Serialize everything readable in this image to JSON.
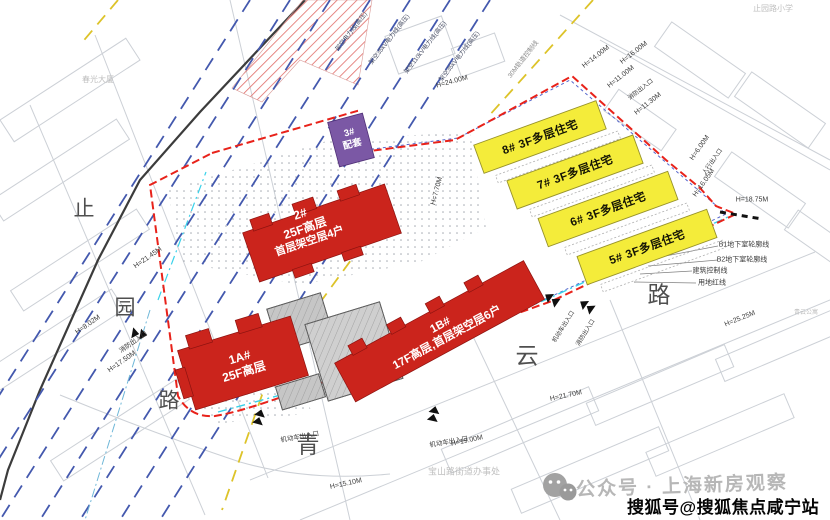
{
  "roads": {
    "left": {
      "name": "止园路",
      "chars": [
        "止",
        "园",
        "路"
      ]
    },
    "bottom": {
      "name": "青云路",
      "chars": [
        "青",
        "云",
        "路"
      ]
    }
  },
  "buildings": {
    "b1a": {
      "line1": "1A#",
      "line2": "25F高层"
    },
    "b1b": {
      "line1": "1B#",
      "line2": "17F高层,首层架空层6户"
    },
    "b2": {
      "line1": "2#",
      "line2": "25F高层",
      "line3": "首层架空层4户"
    },
    "b3": {
      "line1": "3#",
      "line2": "配套"
    },
    "b5": {
      "label": "5#  3F多层住宅"
    },
    "b6": {
      "label": "6#  3F多层住宅"
    },
    "b7": {
      "label": "7#  3F多层住宅"
    },
    "b8": {
      "label": "8#  3F多层住宅"
    }
  },
  "heights": {
    "h2145": "H=21.45M",
    "h802": "H=8.02M",
    "h1750": "H=17.50M",
    "h2400": "H=24.00M",
    "h770": "H=7.70M",
    "h1400": "H=14.00M",
    "h1600": "H=16.00M",
    "h1100": "H=11.00M",
    "h1130": "H=11.30M",
    "h600": "H=6.00M",
    "h1605": "H=16.05M",
    "h1875": "H=18.75M",
    "h2525": "H=25.25M",
    "h2170": "H=21.70M",
    "h1900": "H=19.00M",
    "h1510": "H=15.10M"
  },
  "lines": {
    "b1_outline": "B1地下室轮廓线",
    "b2_outline": "B2地下室轮廓线",
    "control": "建筑控制线",
    "red_line": "用地红线",
    "rail": "30M轨道控制线",
    "power1": "架空电力线(高压)",
    "power2": "架空35kV电力线(高压)",
    "power3": "架空110kV电力线(高压)",
    "power4": "架空35kV电力线(高压)"
  },
  "entrances": {
    "fire": "消防出入口",
    "vehicle": "机动车出入口",
    "pedestrian": "人行出入口"
  },
  "landmarks": {
    "school": "止园路小学",
    "office": "宝山路街道办事处",
    "tower": "春光大厦",
    "apartment": "青云公寓"
  },
  "watermarks": {
    "wechat": "公众号 · 上海新房观察",
    "sohu": "搜狐号@搜狐焦点咸宁站"
  },
  "colors": {
    "highrise_red": "#cb241c",
    "lowrise_yellow": "#f4ec3a",
    "support_purple": "#7b58a5",
    "boundary_red": "#e8221a",
    "powerline_blue": "#4459ae",
    "waterline_cyan": "#39d2ea",
    "rail_yellow": "#ddc329"
  }
}
